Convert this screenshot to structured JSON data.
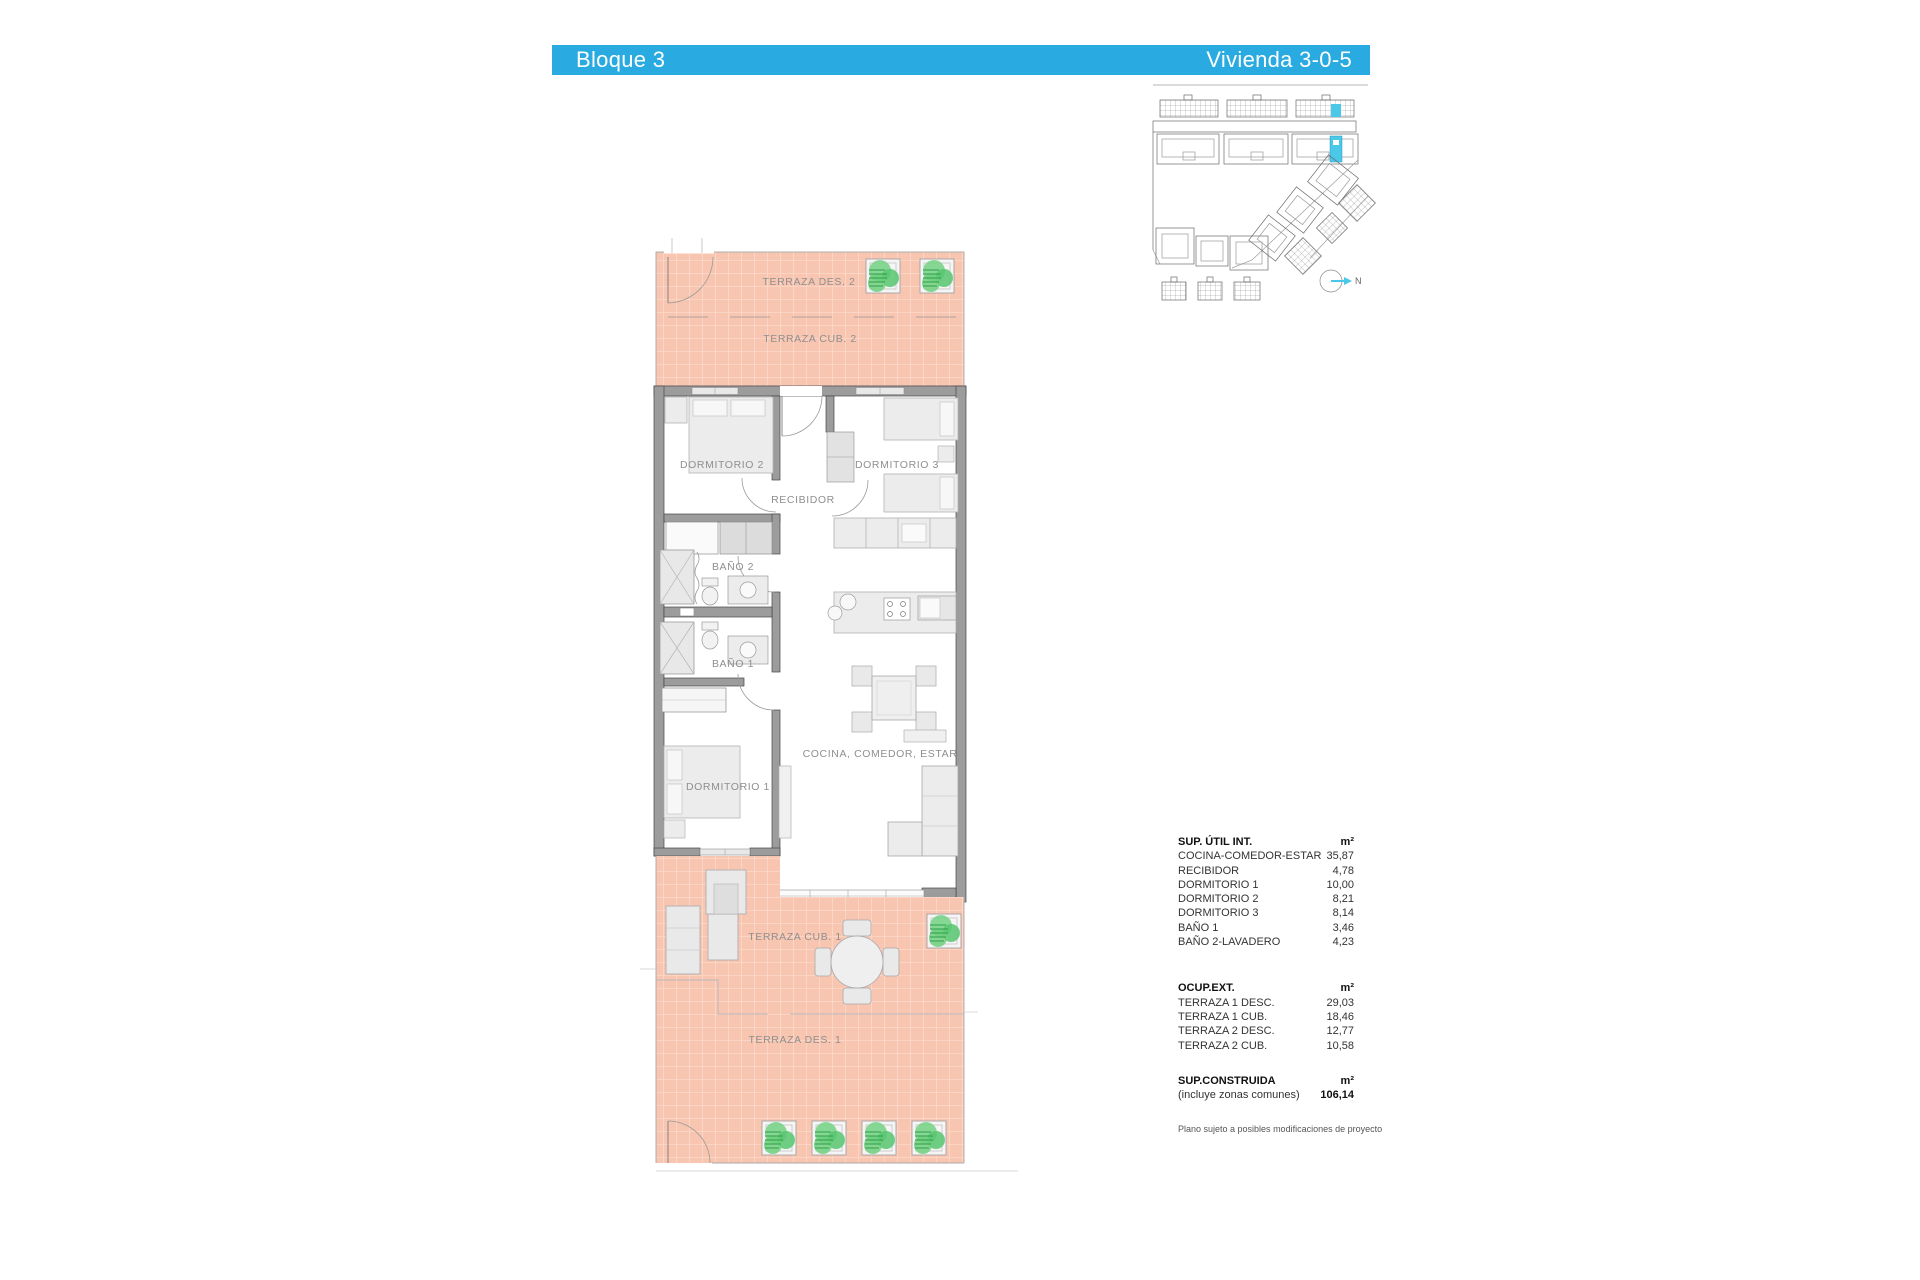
{
  "header": {
    "left": "Bloque 3",
    "right": "Vivienda 3-0-5",
    "accent_color": "#29abe2"
  },
  "plan": {
    "labels": {
      "terraza_des_2": "TERRAZA DES. 2",
      "terraza_cub_2": "TERRAZA CUB. 2",
      "dormitorio_2": "DORMITORIO 2",
      "dormitorio_3": "DORMITORIO 3",
      "recibidor": "RECIBIDOR",
      "bano_2": "BAÑO 2",
      "bano_1": "BAÑO 1",
      "dormitorio_1": "DORMITORIO 1",
      "cocina_comedor_estar": "COCINA, COMEDOR, ESTAR",
      "terraza_cub_1": "TERRAZA CUB. 1",
      "terraza_des_1": "TERRAZA DES. 1"
    },
    "colors": {
      "terrace": "#f8c5b1",
      "terrace_grid": "#fcdacb",
      "wall": "#9c9c9c",
      "wall_stroke": "#474747",
      "furniture": "#ececec",
      "plant_green": "#6fcf7e"
    }
  },
  "key_plan": {
    "north_label": "N",
    "highlight_color": "#4bc7e8"
  },
  "areas_table": {
    "sections": [
      {
        "title": "SUP. ÚTIL INT.",
        "unit": "m²",
        "rows": [
          {
            "label": "COCINA-COMEDOR-ESTAR",
            "value": "35,87"
          },
          {
            "label": "RECIBIDOR",
            "value": "4,78"
          },
          {
            "label": "DORMITORIO 1",
            "value": "10,00"
          },
          {
            "label": "DORMITORIO 2",
            "value": "8,21"
          },
          {
            "label": "DORMITORIO 3",
            "value": "8,14"
          },
          {
            "label": "BAÑO 1",
            "value": "3,46"
          },
          {
            "label": "BAÑO 2-LAVADERO",
            "value": "4,23"
          }
        ]
      },
      {
        "title": "OCUP.EXT.",
        "unit": "m²",
        "rows": [
          {
            "label": "TERRAZA 1 DESC.",
            "value": "29,03"
          },
          {
            "label": "TERRAZA 1 CUB.",
            "value": "18,46"
          },
          {
            "label": "TERRAZA 2 DESC.",
            "value": "12,77"
          },
          {
            "label": "TERRAZA 2 CUB.",
            "value": "10,58"
          }
        ]
      },
      {
        "title": "SUP.CONSTRUIDA",
        "unit": "m²",
        "rows": [
          {
            "label": "(incluye zonas comunes)",
            "value": "106,14"
          }
        ]
      }
    ],
    "footnote": "Plano sujeto a posibles modificaciones de proyecto"
  }
}
